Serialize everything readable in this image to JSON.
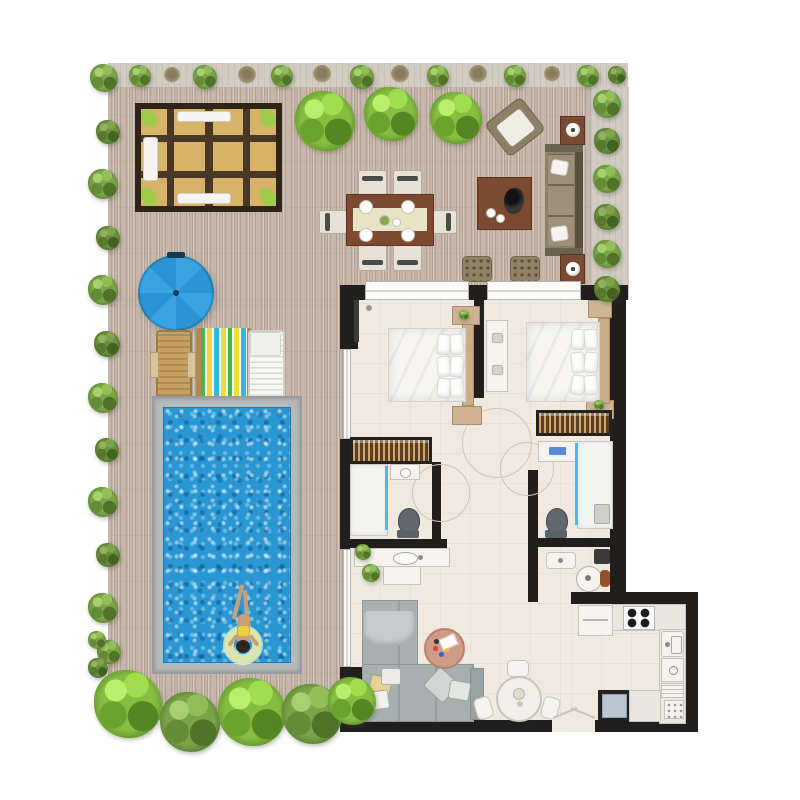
{
  "scene": {
    "type": "apartment-floor-plan-top-view",
    "areas": [
      "terrace-pool-deck",
      "bedroom-1",
      "bedroom-2",
      "bathroom-1",
      "bathroom-2",
      "hallway",
      "living-dining-room",
      "kitchen"
    ]
  },
  "palette": {
    "wall": "#211f1d",
    "deck": "#c6b5a9",
    "planter": "#d2ccc3",
    "floor": "#efe9e0",
    "pool_water": "#2a97d3",
    "pool_coping": "#b7b9ba",
    "umbrella_blue": "#38a5e2",
    "pergola_tan": "#d9b269",
    "pergola_frame": "#2f2517",
    "foliage_green": "#7ba449",
    "accent_green": "#9ccf4a",
    "outdoor_khaki": "#8b8167",
    "table_brown": "#7c4a33",
    "sofa_gray": "#a7b0af",
    "shower_glass_blue": "#49b9e8",
    "lounger_wood": "#c49b62",
    "stripe_yellow": "#f2d93b",
    "stripe_blue": "#35b7d9",
    "stripe_green": "#4ab54a"
  },
  "terrace": {
    "furniture": [
      {
        "name": "pergola-seating",
        "color": "#d9b269"
      },
      {
        "name": "outdoor-dining-table",
        "seats": 6,
        "place_settings": 4
      },
      {
        "name": "outdoor-sofa",
        "pillows": 2
      },
      {
        "name": "outdoor-lounge-chair",
        "rotated": true
      },
      {
        "name": "outdoor-coffee-table"
      },
      {
        "name": "side-table-with-lamp",
        "count": 2
      },
      {
        "name": "pouf",
        "count": 2
      },
      {
        "name": "parasol",
        "color": "#38a5e2"
      },
      {
        "name": "sun-lounger-wood"
      },
      {
        "name": "deck-chair-striped"
      },
      {
        "name": "sun-lounger-white"
      }
    ],
    "pool": {
      "shape": "rectangle",
      "occupant": "swimmer-on-ring-float",
      "float_color": "#d8e6ac",
      "swimsuit_color": "#e8d23a"
    },
    "planting": {
      "left_bushes": 14,
      "top_bushes": 14,
      "right_bushes": 6,
      "large_trees": 3,
      "bottom_bushes": 5,
      "indoor_plants": 4
    }
  },
  "apartment": {
    "rooms": [
      {
        "name": "bedroom-1",
        "furniture": [
          "double-bed",
          "pillows-x6",
          "headboard",
          "nightstand-top",
          "nightstand-bottom",
          "wardrobe",
          "tv-panel"
        ]
      },
      {
        "name": "bedroom-2",
        "furniture": [
          "double-bed",
          "pillows-x6",
          "headboard",
          "nightstand-top",
          "nightstand-bottom",
          "wardrobe",
          "console-dresser"
        ]
      },
      {
        "name": "bathroom-1",
        "furniture": [
          "shower",
          "washbasin",
          "toilet",
          "vanity-counter",
          "plant"
        ]
      },
      {
        "name": "bathroom-2",
        "furniture": [
          "washer",
          "shower",
          "toilet"
        ]
      },
      {
        "name": "laundry-nook",
        "furniture": [
          "soap-tray",
          "pedestal-sink",
          "bottle",
          "bin"
        ]
      },
      {
        "name": "living-dining-room",
        "furniture": [
          "corner-sofa",
          "throw-blanket",
          "pillows",
          "round-coffee-table",
          "round-dining-table",
          "dining-chairs-x3",
          "sideboard",
          "plant"
        ]
      },
      {
        "name": "kitchen",
        "furniture": [
          "refrigerator",
          "cooktop-4-burners",
          "sink",
          "oven",
          "drawers",
          "small-appliance",
          "dishwasher",
          "counter"
        ]
      }
    ],
    "openings": [
      "terrace-windows-x2",
      "glass-wall-bedroom-1",
      "glass-wall-living-room",
      "entrance-door-bottom"
    ]
  }
}
